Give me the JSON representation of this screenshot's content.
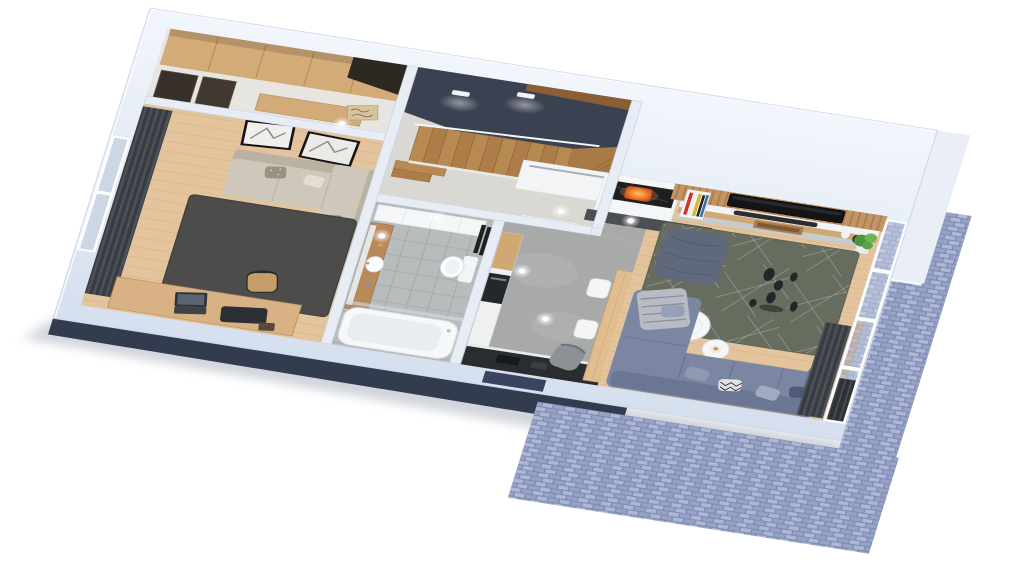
{
  "scene": {
    "type": "3d-floorplan-render",
    "view": "isometric cutaway, viewed from above at an angle",
    "background": "#ffffff",
    "description": "Photoreal 3D floor plan of a single apartment storey: entry hall with wardrobe, staircase hall with dark feature wall, bedroom/study, bathroom, kitchen corridor and open living room with balcony-side brick facade"
  },
  "palette": {
    "bg": "#ffffff",
    "wall_light": "#f2f6fc",
    "wall": "#dde6f3",
    "wall_edge": "#c7d2e5",
    "wall_band": "#e9eef7",
    "facade_navy": "#333b4e",
    "recess_navy": "#3a4460",
    "shadow": "#9aa3b0",
    "brick_joint": "#7e8bb1",
    "brick_a": "#97a3c6",
    "brick_b": "#aeb8d6",
    "floor_wood": "#e4c49c",
    "plank_line": "#caa87d",
    "floor_pale": "#e7e5e0",
    "stairhall_floor": "#dad8d2",
    "concrete": "#a8aaa9",
    "concrete_light": "#bdbfbe",
    "tile": "#b9bcbc",
    "tile_line": "#a3a6a6",
    "dark_wall": "#3a4150",
    "wood_cap": "#8a5f35",
    "stair_a": "#b78953",
    "stair_b": "#ad7d49",
    "stair_line": "#8f6233",
    "rail_white": "#f5f6f8",
    "door_white": "#f6f8fa",
    "door_dark": "#37302b",
    "wardrobe_wood": "#d3ab79",
    "wardrobe_dark": "#2e2823",
    "sign_wood": "#d9c39c",
    "curtain_dark": "#383c42",
    "curtain_light": "#4c5158",
    "rug_bedroom": "#4c4c4a",
    "sofa_beige": "#cfc8ba",
    "sofa_beige_dark": "#b9b1a2",
    "pillow_taupe": "#9a9183",
    "desk_wood": "#d8b284",
    "laptop_dark": "#30343a",
    "chair_wood": "#c79e6a",
    "fixture_white": "#f6f8f9",
    "fixture_shade": "#e9edef",
    "vanity_wood": "#b9895a",
    "radiator_black": "#1e2022",
    "oven_black": "#25282b",
    "counter_black": "#2a2d30",
    "cabinet_white": "#eef0f2",
    "cabinet_wood": "#cfa874",
    "table_wood": "#e0bd8e",
    "chair_white": "#f3f5f6",
    "chair_grey": "#85898d",
    "armchair_grey": "#8d9196",
    "slat_wood": "#c49465",
    "slat_line": "#a87f4e",
    "tv_black": "#121416",
    "console_white": "#f1f3f5",
    "console_grey": "#c6cbd1",
    "soundbar": "#2a2d31",
    "marble_black": "#1d2022",
    "hearth_grey": "#4b4e53",
    "fire_orange": "#f07f2e",
    "fire_deep": "#c2451d",
    "book_red": "#c8372f",
    "book_yellow": "#d9b832",
    "book_blue": "#3a6ea5",
    "rug_living": "#666d5e",
    "rug_line": "#e8e8e2",
    "pouf_slate": "#60697c",
    "sofa_blue": "#7b87a2",
    "sofa_blue_dark": "#6a7694",
    "pillow_light": "#96a1b8",
    "pillow_dark": "#515a74",
    "blanket_grey": "#b7bcc4",
    "vase_black": "#23262a",
    "plant_green": "#4e9440",
    "plant_light": "#6fb558",
    "glass": "#ccd7e3",
    "louver_dark": "#2e3136",
    "louver_line": "#4a4e54"
  },
  "rooms": [
    {
      "id": "entry-hall",
      "name": "Entry hall with wardrobe",
      "floor": "pale screed",
      "furniture": [
        "built-in wood wardrobe",
        "dark tall cabinet",
        "two dark interior doors",
        "wood bench",
        "decorative welcome sign"
      ]
    },
    {
      "id": "staircase-hall",
      "name": "Staircase hall",
      "floor": "pale screed",
      "furniture": [
        "L-shaped wooden staircase with winders",
        "dark feature wall",
        "wood cap strip",
        "two wall sconces",
        "white entrance door",
        "white handrail"
      ]
    },
    {
      "id": "bedroom",
      "name": "Bedroom / study",
      "floor": "wood planks",
      "furniture": [
        "beige corner sofa",
        "patterned cushions",
        "two black-framed pictures",
        "dark full-height curtains",
        "west window",
        "dark grey rug",
        "desk with laptop and desk mat",
        "wooden chair"
      ]
    },
    {
      "id": "bathroom",
      "name": "Bathroom",
      "floor": "grey tile",
      "furniture": [
        "wooden vanity column with round sink",
        "mirror strip",
        "wall-hung toilet",
        "black towel radiator",
        "white tall cabinet",
        "bathtub",
        "glass shower screen",
        "ceiling spots"
      ]
    },
    {
      "id": "kitchen-corridor",
      "name": "Kitchen corridor",
      "floor": "polished concrete",
      "furniture": [
        "kitchen run with wood and white fronts",
        "built-in black oven",
        "black counter along south wall",
        "white wall unit with metal shelf",
        "long wooden dining table",
        "two white chairs",
        "two grey chairs",
        "grey armchair",
        "white bathroom door"
      ]
    },
    {
      "id": "living-room",
      "name": "Living room",
      "floor": "wood planks",
      "furniture": [
        "flat TV on wooden slat wall",
        "media console with black soundbar",
        "magazine shelf with colourful spines",
        "fireplace in black marble",
        "dark hearth slab",
        "grey-green rug with line pattern",
        "slate floor-cushion pouf",
        "cluster of black decorative vases",
        "two round white coffee tables",
        "blue-grey corner sofa",
        "five throw pillows",
        "grey fringed blanket",
        "potted green plant",
        "decorative white and black vases",
        "panoramic east windows",
        "dark curtain panel",
        "roller-louver band"
      ]
    }
  ],
  "exterior": {
    "elements": [
      "white-blue cut wall ring",
      "wide white band over living room",
      "navy plinth along south facade",
      "navy window recess in south wall",
      "blue brick facade strips along east side",
      "brick apron wrapping the south-east corner",
      "soft drop shadow on white ground"
    ]
  }
}
